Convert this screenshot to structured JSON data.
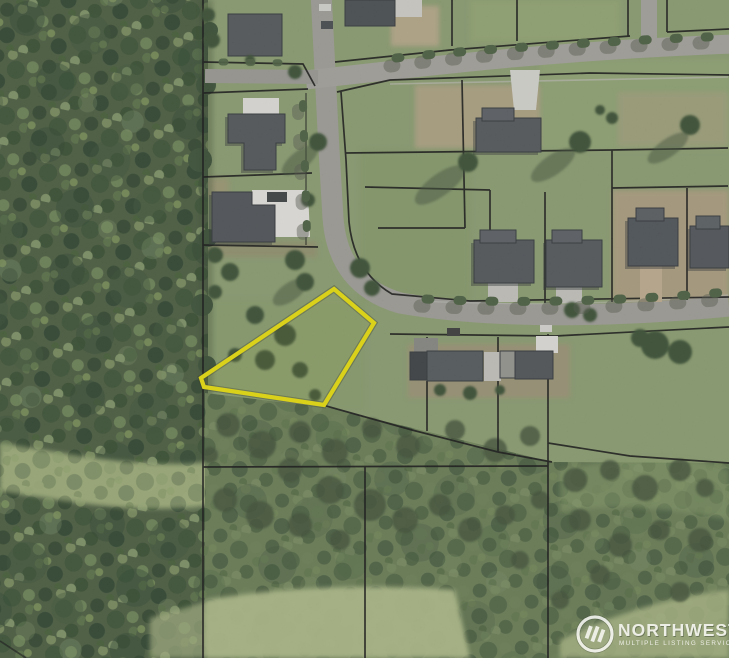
{
  "map": {
    "kind": "aerial-parcel-photo",
    "highlighted_parcel": {
      "outline_color": "#f2e70c",
      "points": "334,289 374,323 324,405 204,387 201,378"
    },
    "palette": {
      "forest": "#4c5f41",
      "grass": "#8fa273",
      "meadow": "#b4c18c",
      "road": "#a3a29b",
      "roof": "#54595d",
      "dirt": "#b3a284",
      "concrete": "#e6e5e0",
      "parcel_line": "#161616"
    }
  },
  "watermark": {
    "brand": "NORTHWEST",
    "tagline": "MULTIPLE LISTING SERVICE",
    "logo": "nwmls-circle-stripes-logo",
    "color": "#fbfbf8"
  }
}
